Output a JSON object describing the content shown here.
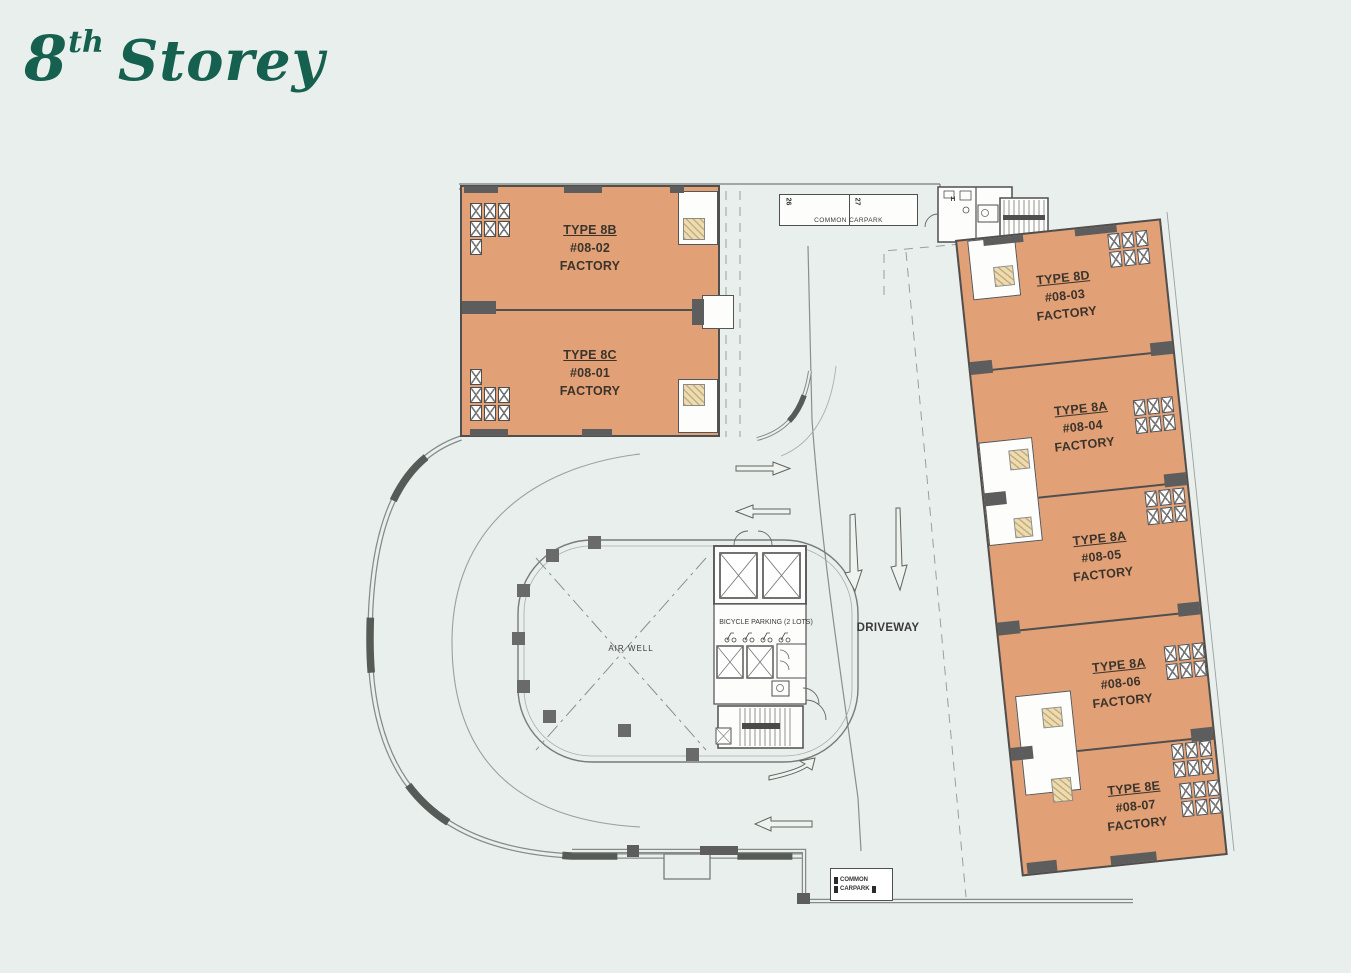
{
  "page": {
    "title": {
      "number": "8",
      "ordinal": "th",
      "word": "Storey"
    }
  },
  "colors": {
    "background": "#e9efec",
    "unit-fill": "#e2a077",
    "wall": "#4f4f4f",
    "title-green": "#15604e",
    "hatch-tan": "#ecdcb4",
    "line": "#8a8f8c"
  },
  "left_block": {
    "units": [
      {
        "type_label": "TYPE 8B",
        "unit_no": "#08-02",
        "use": "FACTORY"
      },
      {
        "type_label": "TYPE 8C",
        "unit_no": "#08-01",
        "use": "FACTORY"
      }
    ]
  },
  "right_block": {
    "units": [
      {
        "type_label": "TYPE 8D",
        "unit_no": "#08-03",
        "use": "FACTORY"
      },
      {
        "type_label": "TYPE 8A",
        "unit_no": "#08-04",
        "use": "FACTORY"
      },
      {
        "type_label": "TYPE 8A",
        "unit_no": "#08-05",
        "use": "FACTORY"
      },
      {
        "type_label": "TYPE 8A",
        "unit_no": "#08-06",
        "use": "FACTORY"
      },
      {
        "type_label": "TYPE 8E",
        "unit_no": "#08-07",
        "use": "FACTORY"
      }
    ]
  },
  "labels": {
    "air_well": "AIR WELL",
    "driveway": "DRIVEWAY",
    "bicycle_parking": "BICYCLE PARKING (2 LOTS)",
    "common_carpark": "COMMON CARPARK",
    "carpark_bottom_line1": "COMMON",
    "carpark_bottom_line2": "CARPARK",
    "lot_left": "26",
    "lot_right": "27",
    "stair_room": "H"
  }
}
